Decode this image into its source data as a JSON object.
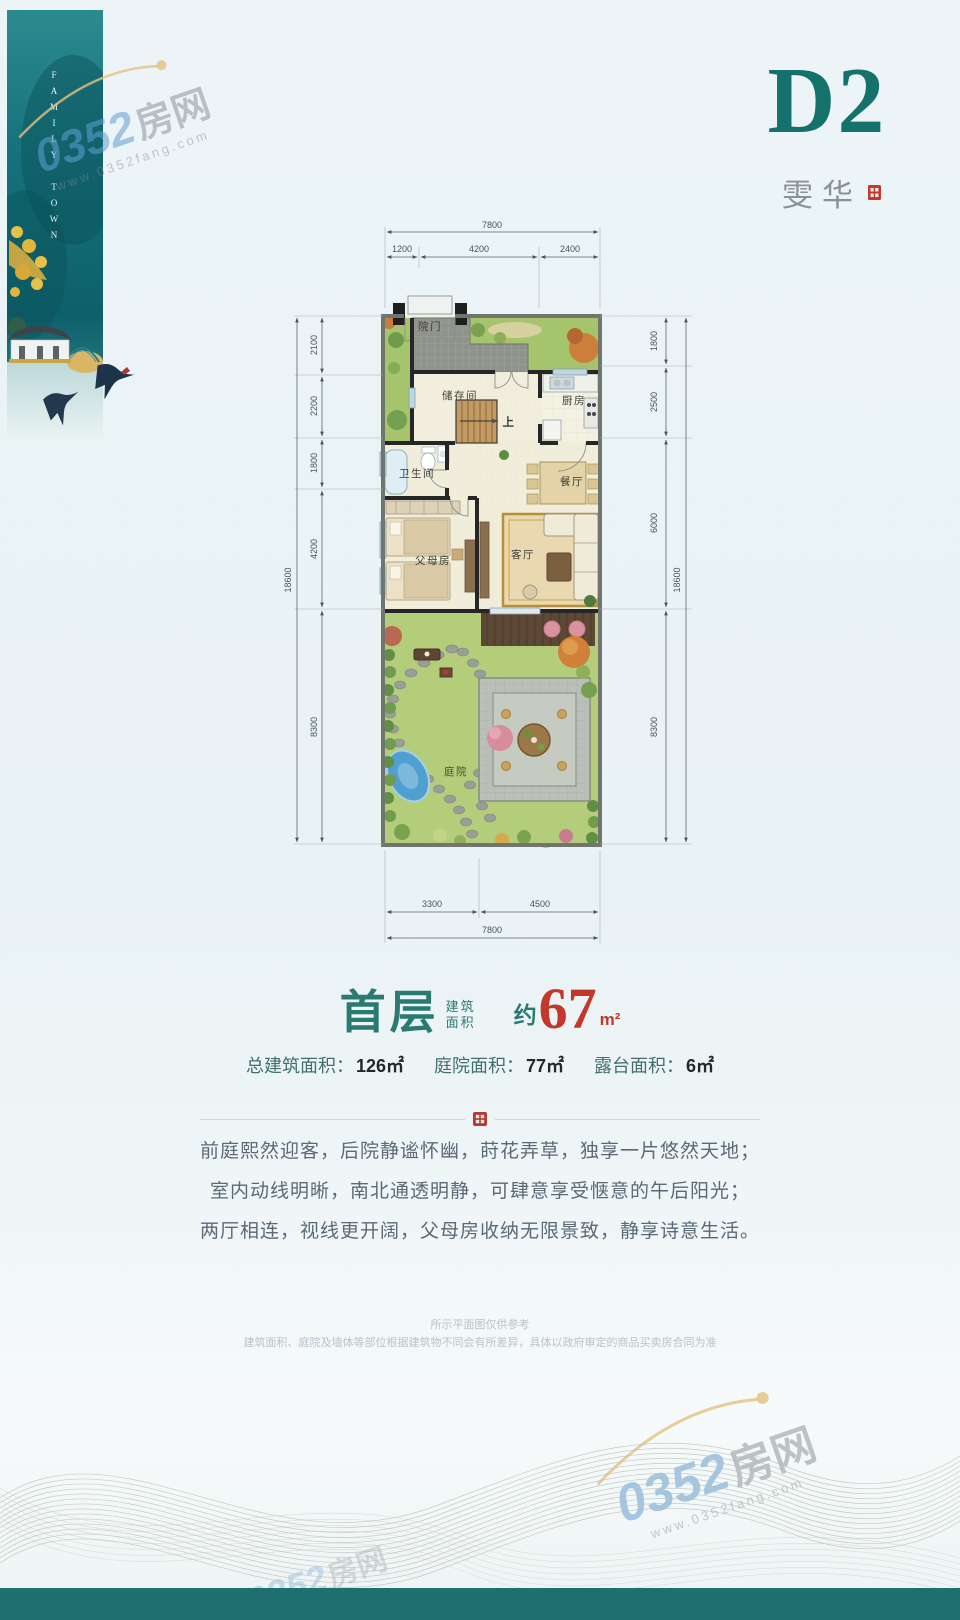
{
  "colors": {
    "brand_teal": "#15716c",
    "accent_red": "#c2392c",
    "footer_teal": "#1d6f70",
    "lawn_green": "#a6c46b",
    "plan_floor": "#f1eedd"
  },
  "banner": {
    "vertical_text": "FAMILY TOWN"
  },
  "watermark": {
    "number": "0352",
    "suffix": "房网",
    "url": "www.0352fang.com"
  },
  "header": {
    "unit": "D2",
    "name": "雯华"
  },
  "plan": {
    "rooms": {
      "gate": "院门",
      "storage": "储存间",
      "up": "上",
      "kitchen": "厨房",
      "bathroom": "卫生间",
      "dining": "餐厅",
      "parents": "父母房",
      "living": "客厅",
      "courtyard": "庭院"
    },
    "dims": {
      "top_total": "7800",
      "top_segs": [
        "1200",
        "4200",
        "2400"
      ],
      "bottom_segs": [
        "3300",
        "4500"
      ],
      "bottom_total": "7800",
      "left_total": "18600",
      "left_segs": [
        "2100",
        "2200",
        "1800",
        "4200",
        "8300"
      ],
      "right_segs": [
        "1800",
        "2500",
        "6000",
        "8300"
      ],
      "right_total": "18600"
    }
  },
  "summary": {
    "floor": "首层",
    "floor_sub_top": "建筑",
    "floor_sub_bottom": "面积",
    "approx": "约",
    "area": "67",
    "unit": "m²",
    "stats": [
      {
        "label": "总建筑面积：",
        "value": "126㎡"
      },
      {
        "label": "庭院面积：",
        "value": "77㎡"
      },
      {
        "label": "露台面积：",
        "value": "6㎡"
      }
    ]
  },
  "description": {
    "lines": [
      "前庭熙然迎客，后院静谧怀幽，莳花弄草，独享一片悠然天地；",
      "室内动线明晰，南北通透明静，可肆意享受惬意的午后阳光；",
      "两厅相连，视线更开阔，父母房收纳无限景致，静享诗意生活。"
    ]
  },
  "disclaimer": {
    "line1": "所示平面图仅供参考",
    "line2": "建筑面积、庭院及墙体等部位根据建筑物不同会有所差异，具体以政府审定的商品买卖房合同为准"
  }
}
